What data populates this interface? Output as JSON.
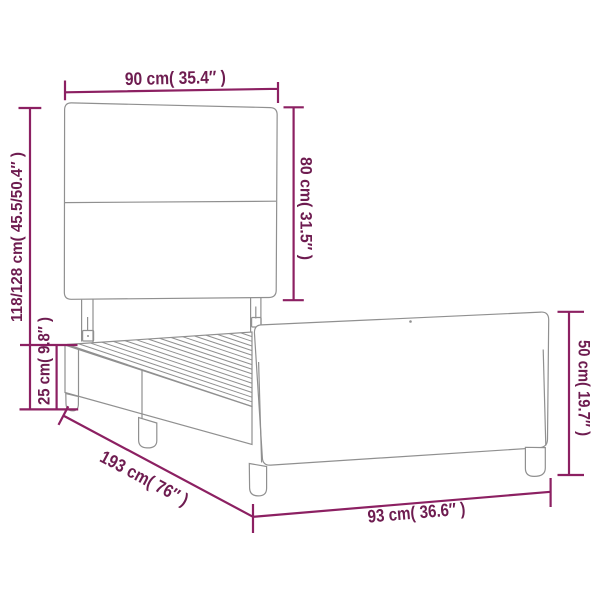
{
  "diagram": {
    "kind": "product-dimension-diagram",
    "colors": {
      "background": "#ffffff",
      "outline": "#909090",
      "dim_line": "#8C2062",
      "dim_text": "#6E1C50"
    }
  },
  "labels": {
    "headboard_width": "90 cm( 35.4″ )",
    "headboard_height": "80 cm( 31.5″ )",
    "total_height": "118/128 cm( 45.5/50.4″ )",
    "base_height": "25 cm( 9.8″ )",
    "length": "193 cm( 76″ )",
    "footboard_width": "93 cm( 36.6″ )",
    "footboard_height": "50 cm( 19.7″ )"
  }
}
